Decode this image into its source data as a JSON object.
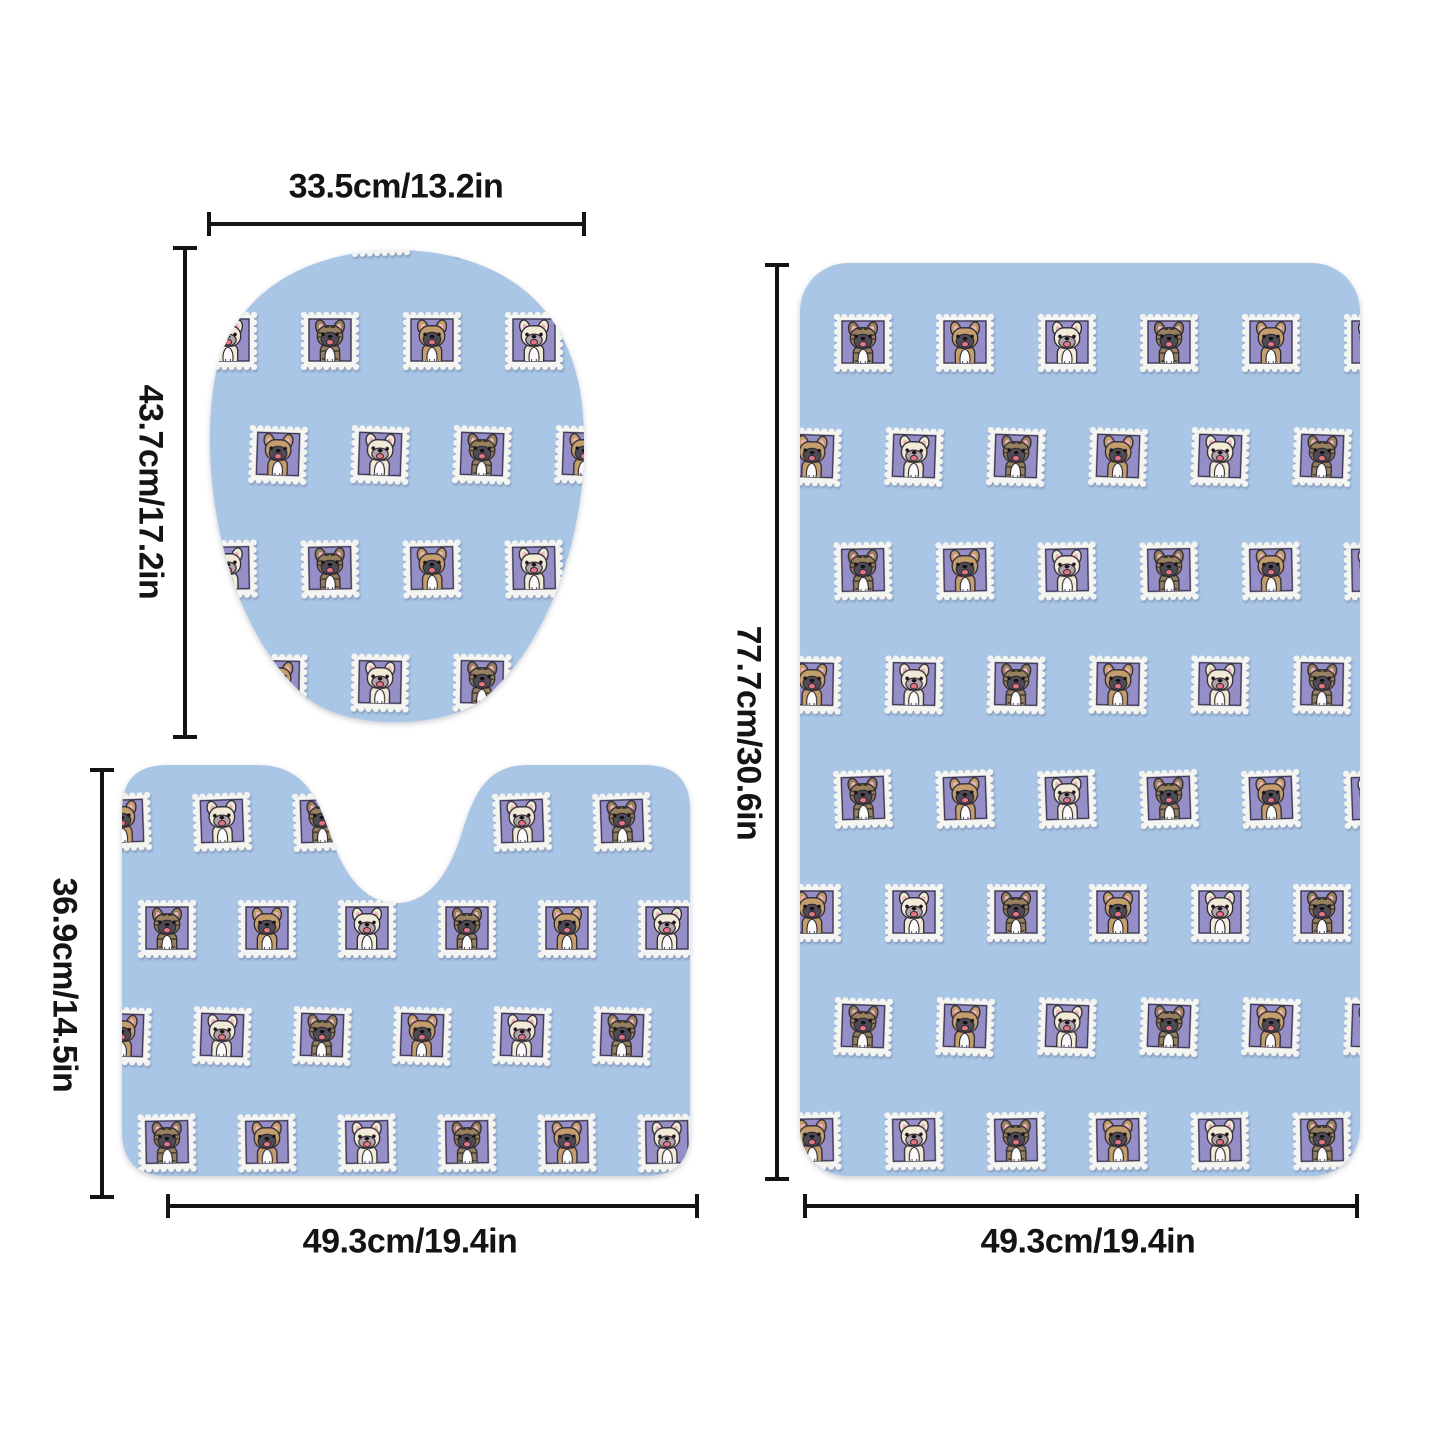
{
  "dimensions": {
    "lid_cover": {
      "width": "33.5cm/13.2in",
      "height": "43.7cm/17.2in"
    },
    "contour_mat": {
      "width": "49.3cm/19.4in",
      "height": "36.9cm/14.5in"
    },
    "bath_mat": {
      "width": "49.3cm/19.4in",
      "height": "77.7cm/30.6in"
    }
  },
  "pattern": {
    "stamp_icon": "french-bulldog-stamp-icon",
    "dog_variants": [
      "cream",
      "brindle",
      "fawn"
    ]
  },
  "colors": {
    "page_bg": "#ffffff",
    "mat_blue": "#a9c6e6",
    "stamp_white": "#f4f4f1",
    "stamp_purple": "#968fc7",
    "stamp_purple_border": "#3a3552",
    "outline": "#2e2a33",
    "dog_cream_coat": "#f1ead6",
    "dog_fawn_coat": "#c49e6c",
    "dog_brindle_coat": "#97815f",
    "brindle_stripe": "#453a28",
    "dog_mask": "#4f4c56",
    "ear_pink": "#eeb4bf",
    "tongue_pink": "#e57484",
    "chest_white": "#fcfcfd",
    "cream_muzzle": "#b3a2a9",
    "dimension_line": "#141414"
  }
}
